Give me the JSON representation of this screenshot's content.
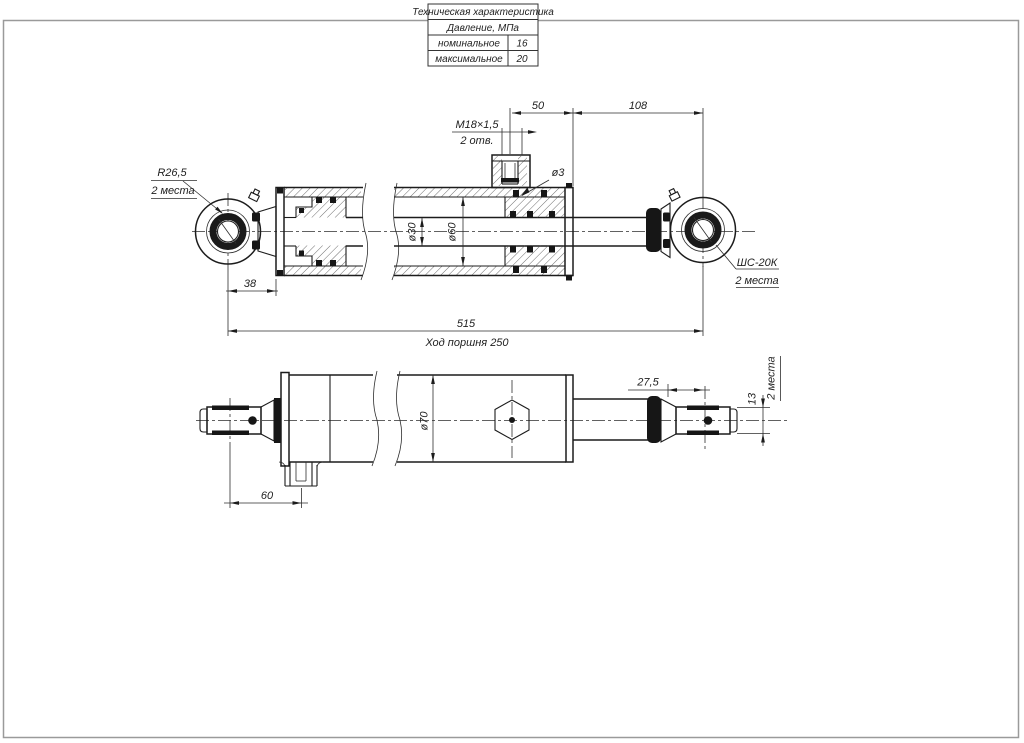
{
  "sheet": {
    "background": "#ffffff",
    "ink_color": "#1c1c1c",
    "frame_color": "#9a9a9a"
  },
  "spec_table": {
    "title": "Техническая характеристика",
    "group": "Давление, МПа",
    "rows": [
      {
        "label": "номинальное",
        "value": "16"
      },
      {
        "label": "максимальное",
        "value": "20"
      }
    ]
  },
  "main_view": {
    "dim_port_to_end": "50",
    "dim_end_to_eye": "108",
    "thread_label": "M18×1,5",
    "thread_note": "2 отв.",
    "orifice_label": "ø3",
    "eye_radius_label": "R26,5",
    "eye_radius_note": "2 места",
    "rod_dia_label": "ø30",
    "bore_dia_label": "ø60",
    "dim_eye_to_flange": "38",
    "dim_overall": "515",
    "stroke_label": "Ход поршня 250",
    "bearing_label": "ШС-20К",
    "bearing_note": "2 места"
  },
  "side_view": {
    "body_dia_label": "ø70",
    "dim_collar_to_eye": "27,5",
    "eye_width_label": "13",
    "eye_width_note": "2 места",
    "dim_eye_to_port": "60"
  }
}
